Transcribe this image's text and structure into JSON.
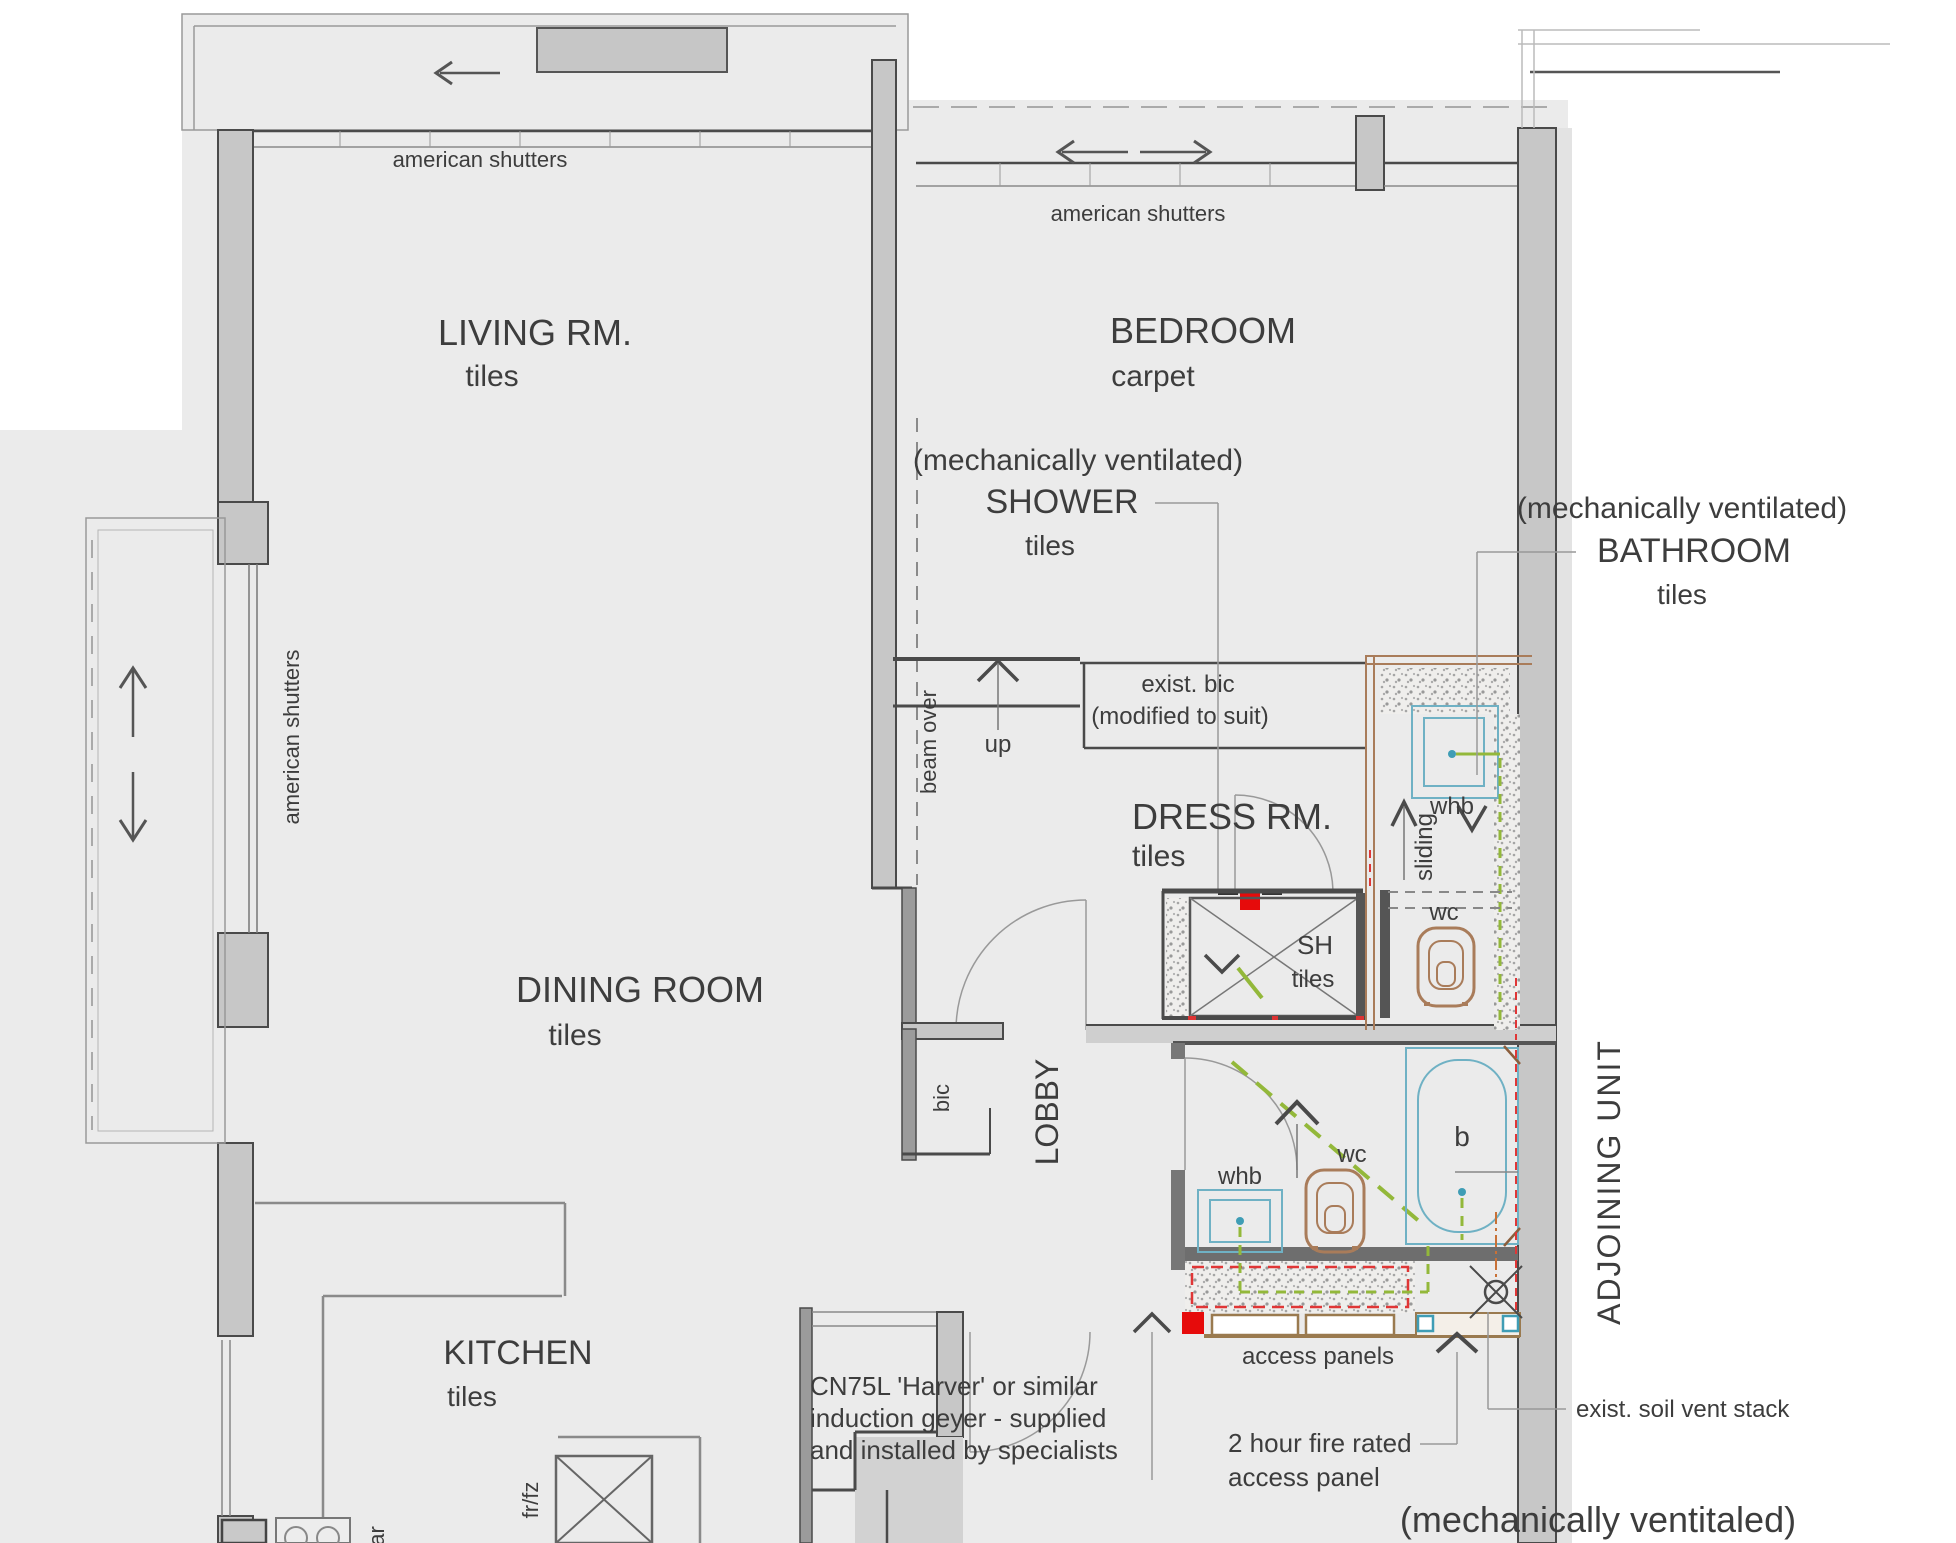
{
  "rooms": {
    "living": {
      "name": "LIVING RM.",
      "finish": "tiles"
    },
    "dining": {
      "name": "DINING ROOM",
      "finish": "tiles"
    },
    "kitchen": {
      "name": "KITCHEN",
      "finish": "tiles"
    },
    "bedroom": {
      "name": "BEDROOM",
      "finish": "carpet"
    },
    "shower": {
      "note": "(mechanically ventilated)",
      "name": "SHOWER",
      "finish": "tiles"
    },
    "bathroom": {
      "note": "(mechanically ventilated)",
      "name": "BATHROOM",
      "finish": "tiles"
    },
    "dress": {
      "name": "DRESS RM.",
      "finish": "tiles"
    },
    "sh": {
      "name": "SH",
      "finish": "tiles"
    },
    "lobby": {
      "name": "LOBBY"
    },
    "adjoining": {
      "name": "ADJOINING UNIT"
    },
    "mech_vent_bottom": "(mechanically ventitaled)"
  },
  "fixtures": {
    "whb_ensuite": "whb",
    "wc_ensuite": "wc",
    "sliding_door": "sliding",
    "whb_bathroom": "whb",
    "wc_bathroom": "wc",
    "bath": "b",
    "bic_lobby": "bic",
    "exist_bic": "exist. bic",
    "exist_bic_note": "(modified to suit)",
    "fridge_freezer": "fr/fz",
    "appliance_fragment": "ar"
  },
  "annotations": {
    "shutters_living": "american shutters",
    "shutters_bedroom": "american shutters",
    "shutters_dining": "american shutters",
    "beam_over": "beam over",
    "stairs_up": "up",
    "access_panels": "access panels",
    "fire_rated_line1": "2 hour fire rated",
    "fire_rated_line2": "access panel",
    "soil_vent": "exist. soil vent stack",
    "geyser_line1": "CN75L 'Harver' or similar",
    "geyser_line2": "induction geyer - supplied",
    "geyser_line3": "and installed by specialists"
  },
  "colors": {
    "floor": "#ebebeb",
    "wall_fill": "#c7c7c7",
    "wall_line": "#4a4a4a",
    "marker_red": "#e60b0b",
    "pipe_green": "#93b83a",
    "fixture_blue": "#6fb1c4",
    "fixture_brown": "#a97c5a",
    "panel_brown": "#9a7a4f",
    "text": "#3d3d3d"
  }
}
